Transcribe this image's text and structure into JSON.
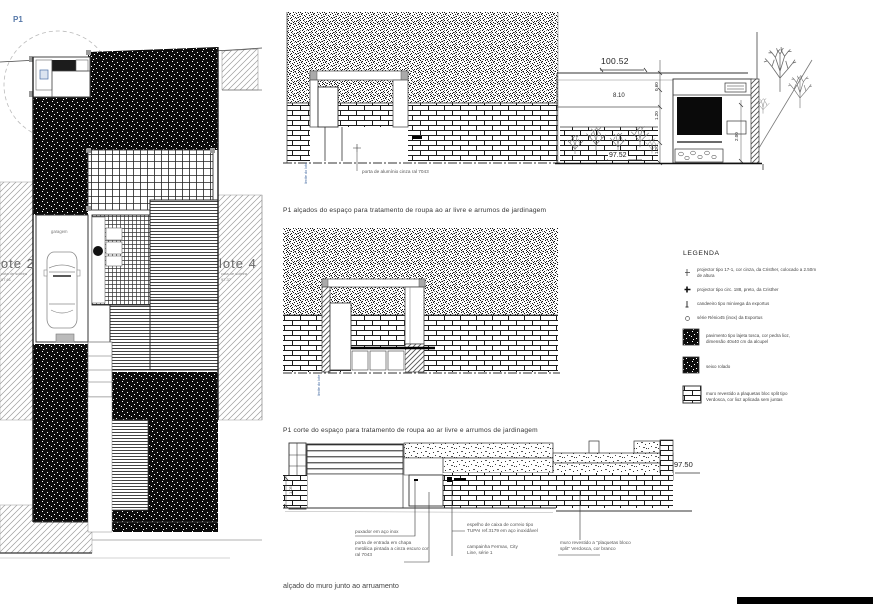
{
  "sheet": {
    "p1": "P1",
    "footer_caption": "alçado do muro junto ao arruamento"
  },
  "site_plan": {
    "lote2_name": "lote 2",
    "lote2_sub": "cota de soleira",
    "lote2_level": "97.61",
    "lote4_name": "lote 4",
    "lote4_sub": "cota de soleira",
    "lote4_level": "97.37",
    "garage_label": "garagem"
  },
  "elevations_caption": "P1 alçados do espaço para tratamento de roupa ao ar livre e arrumos de jardinagem",
  "section_caption": "P1 corte do espaço para tratamento de roupa ao ar livre e arrumos de jardinagem",
  "elevation_top": {
    "door_label": "porta de alumínio cinza ral 7043",
    "boundary_label": "limite do lote"
  },
  "elevation_right": {
    "dim_total": "100.52",
    "dim_width": "8.10",
    "dim_h1": "0.60",
    "dim_h2": "1.20",
    "dim_h3": "1.20",
    "dim_door": "2.00",
    "level": "97.52"
  },
  "section_mid": {
    "boundary_label": "limite do lote"
  },
  "legend": {
    "title": "LEGENDA",
    "items": [
      {
        "label": "projector tipo 17-1, cor cinza, da Cristher, colocado a 2.50m de altura"
      },
      {
        "label": "projector tipo circ. 188, preto, da Cristher"
      },
      {
        "label": "candeeiro tipo minivega da exportus"
      },
      {
        "label": "série Rénio45 (inox) da Exportus"
      }
    ],
    "swatches": [
      {
        "label": "pavimento tipo lajeta tosca, cor pedra lioz, dimensão 40x40 cm da alcupel"
      },
      {
        "label": "seixo rolado"
      },
      {
        "label": "muro revestido a plaquetas bloc split tipo Verdosca, cor lioz aplicada sem juntas"
      }
    ]
  },
  "street_elevation": {
    "level": "97.50",
    "dim_left": "1.05",
    "labels": {
      "handle": "puxador em aço inox",
      "door": "porta de entrada em chapa metálica pintada a cinza escuro cor ral 7043",
      "mailbox": "espelho de caixa de correio tipo TUPAI ref.3179 em aço inoxidável",
      "bell": "campainha Fermax, City Line, série 1",
      "wall": "muro revestido a \"plaquetas bloco split\" Verdosca, cor branco"
    }
  }
}
